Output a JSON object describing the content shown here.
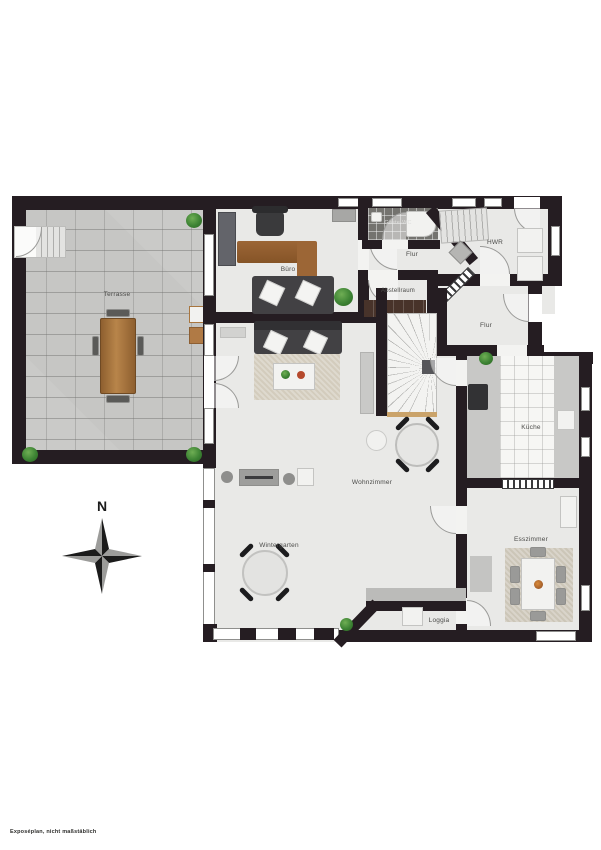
{
  "document": {
    "type": "residential floor plan (ground floor)",
    "footer_note": "Exposéplan, nicht maßstäblich"
  },
  "compass": {
    "north_label": "N"
  },
  "rooms": [
    {
      "id": "terrasse",
      "label": "Terrasse"
    },
    {
      "id": "buero",
      "label": "Büro"
    },
    {
      "id": "gaeste-wc",
      "label": "Gäste-WC"
    },
    {
      "id": "hwr",
      "label": "HWR"
    },
    {
      "id": "flur-oben",
      "label": "Flur"
    },
    {
      "id": "abstellraum",
      "label": "Abstellraum"
    },
    {
      "id": "flur-unten",
      "label": "Flur"
    },
    {
      "id": "kueche",
      "label": "Küche"
    },
    {
      "id": "wohnzimmer",
      "label": "Wohnzimmer"
    },
    {
      "id": "wintergarten",
      "label": "Wintergarten"
    },
    {
      "id": "esszimmer",
      "label": "Esszimmer"
    },
    {
      "id": "loggia",
      "label": "Loggia"
    }
  ],
  "colors": {
    "wall": "#251d22",
    "floor": "#e9e9e7",
    "terrace_paving": "#c6c6c4",
    "wet_room_tile": "#74736f",
    "kitchen_tile": "#f6f6f4",
    "rug": "#d3ccbd",
    "sofa": "#424144",
    "wood": "#ad7a42",
    "plant_green": "#3d8334",
    "compass_dark": "#1b1b1b",
    "compass_light": "#9c9c9a"
  }
}
